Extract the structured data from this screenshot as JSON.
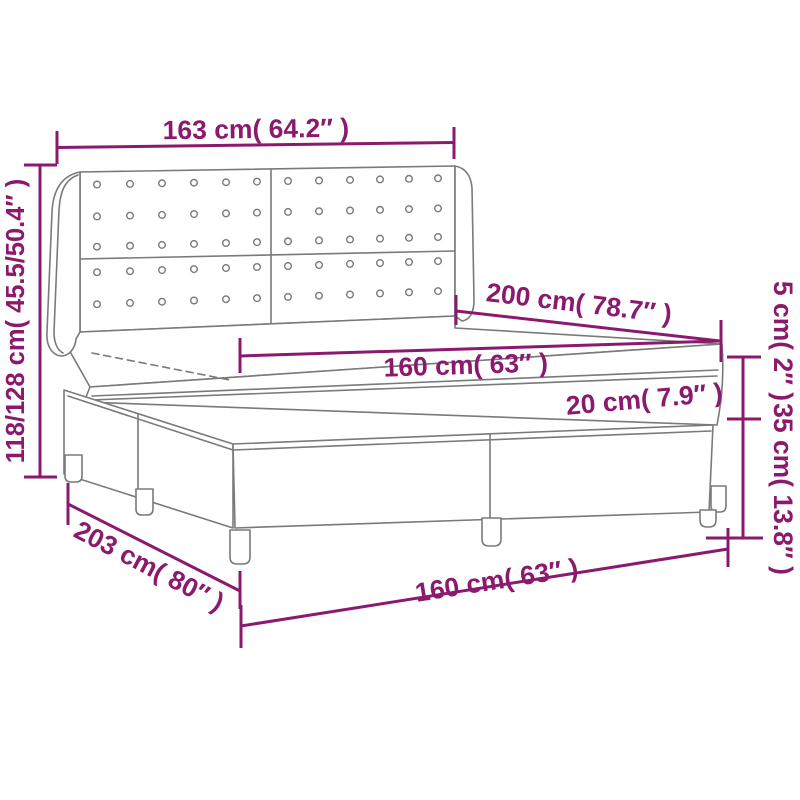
{
  "diagram": {
    "kind": "product dimension diagram",
    "subject": "box spring bed with tufted wing headboard, mattress and topper",
    "background_color": "#ffffff",
    "outline_color": "#7a7a7a",
    "dimension_color": "#8B1A6E"
  },
  "headboard": {
    "panels": 2,
    "button_rows": 5,
    "button_cols_per_panel": 6
  },
  "dims": {
    "headboard_width": {
      "label": "163 cm( 64.2″ )"
    },
    "overall_height": {
      "label": "118/128 cm( 45.5/50.4″ )"
    },
    "bed_length": {
      "label": "200 cm( 78.7″ )"
    },
    "mattress_width": {
      "label": "160 cm( 63″ )"
    },
    "mattress_height": {
      "label": "20 cm( 7.9″ )"
    },
    "topper_height": {
      "label": "5 cm( 2″ )"
    },
    "base_height": {
      "label": "35 cm( 13.8″ )"
    },
    "base_length": {
      "label": "203 cm( 80″ )"
    },
    "base_width": {
      "label": "160 cm( 63″ )"
    }
  }
}
